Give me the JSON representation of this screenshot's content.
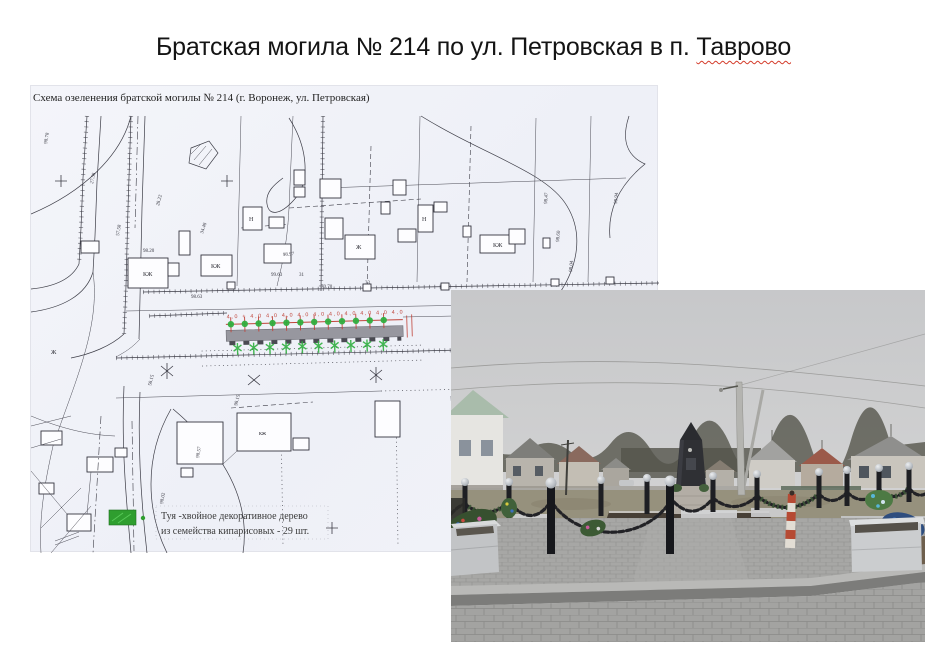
{
  "slide": {
    "title": "Братская могила № 214 по ул. Петровская в п.",
    "title_underlined": "Таврово"
  },
  "map": {
    "caption": "Схема озеленения братской могилы № 214 (г. Воронеж,  ул. Петровская)",
    "dimensions_row": "4,0 + 4,0  4,0  4,0  4,0  4,0  4,0  4,0  4,0  4,0  4,0",
    "legend": {
      "line1": "Туя -хвойное декоративное дерево",
      "line2": "из семейства кипарисовых  - 29 шт.",
      "swatch_color": "#2f9e2f"
    },
    "building_labels": [
      "КЖ",
      "КЖ",
      "Ж",
      "Н",
      "Н",
      "КЖ",
      "кж",
      "Ж"
    ],
    "micro_labels": [
      "98.78",
      "27.58",
      "57.58",
      "34.48",
      "28.22",
      "98.20",
      "99.63",
      "31",
      "70.70",
      "98.63",
      "33",
      "98.97",
      "98.47",
      "98.60",
      "98.04",
      "98.94",
      "98.15",
      "98.57",
      "58.15",
      "98.02"
    ],
    "colors": {
      "paper": "#f1f2f8",
      "ink": "#3c3c46",
      "dimension_red": "#c0443a",
      "tree_green": "#2fae3e",
      "band_gray": "#8e8e96"
    }
  },
  "photo": {
    "description": "Обелиск братской могилы с оградой из чёрных столбиков с цепями, бетонные вазоны, венки, мощёная площадка, сельская улица",
    "colors": {
      "sky": "#c9cacc",
      "pavement": "#a6a6a4",
      "obelisk": "#2f3034",
      "chain": "#222226",
      "planter": "#c9cbcd",
      "striped_post_red": "#b64a33"
    }
  }
}
